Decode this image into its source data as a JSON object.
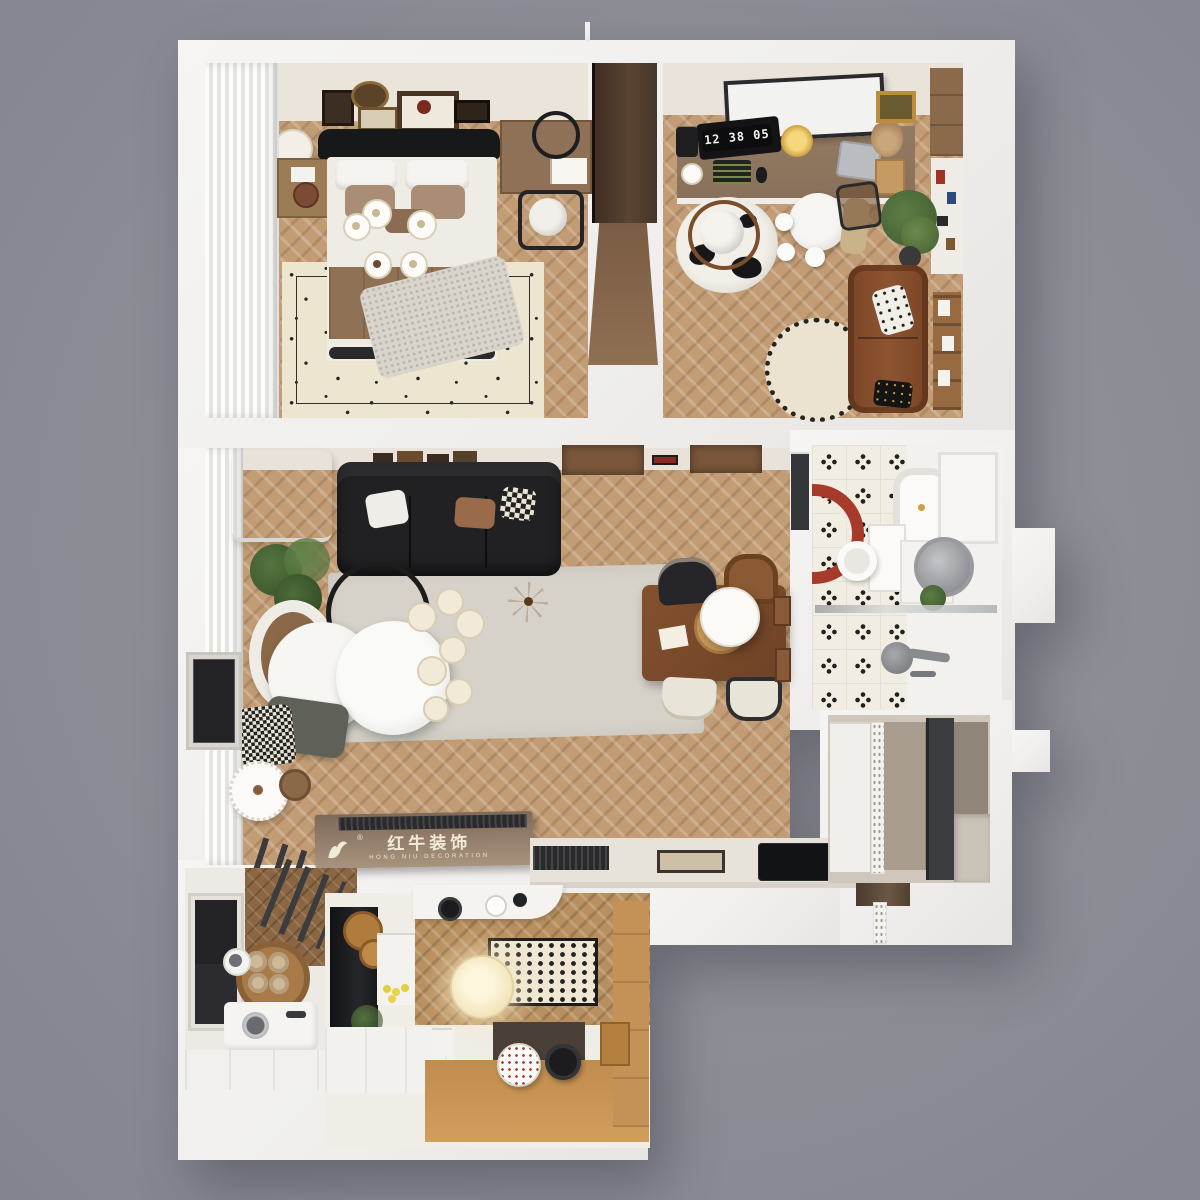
{
  "watermark": {
    "registered_mark": "®",
    "brand_cn": "红牛装饰",
    "brand_en": "HONG NIU DECORATION"
  },
  "study_clock": {
    "time": "12 38 05"
  },
  "palette": {
    "background_gray": "#8c8d95",
    "wall_white": "#f3f2ef",
    "wall_face_beige": "#e9e3d9",
    "wood_floor": "#c29c74",
    "wood_floor_dark": "#b8905f",
    "balcony_parquet": "#8a6742",
    "living_rug_gray": "#d6d2c9",
    "bedroom_rug_cream": "#ece5d0",
    "sofa_black": "#212124",
    "sofa_leather_brown": "#8a5430",
    "dining_table_walnut": "#7a4a2d",
    "console_bronze": "#8d7765",
    "bath_mat_red": "#a63b2b",
    "pumpkin_orange": "#d98a33",
    "lemon_yellow": "#e3cf3e",
    "plant_green": "#4d6b3a",
    "bath_tile_white": "#f1ede3",
    "bath_tile_motif": "#23211e",
    "entry_charcoal": "#3b3d41",
    "bench_oak": "#c89454",
    "lantern_glow": "#f7ecca",
    "headboard_black": "#17181a"
  },
  "rooms": [
    {
      "name": "master-bedroom"
    },
    {
      "name": "study-office"
    },
    {
      "name": "living-dining"
    },
    {
      "name": "bathroom"
    },
    {
      "name": "entry-hall"
    },
    {
      "name": "laundry-balcony"
    },
    {
      "name": "kitchen-nook"
    }
  ]
}
